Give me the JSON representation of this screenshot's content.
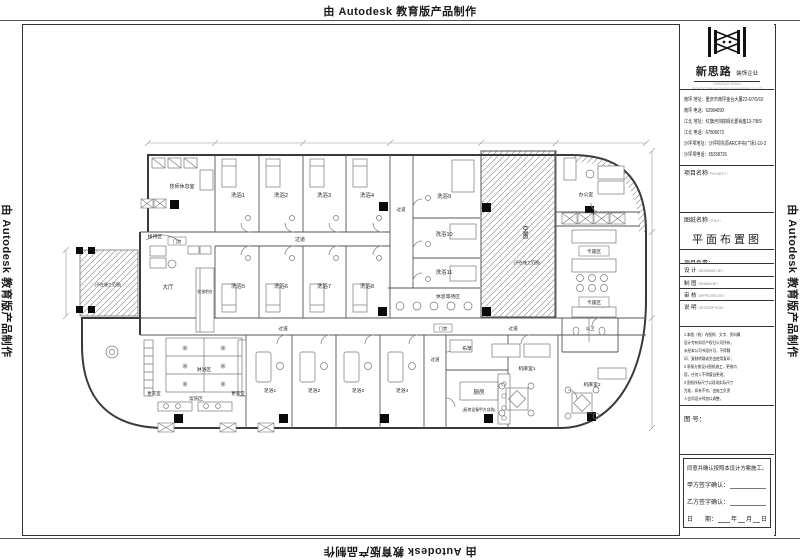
{
  "watermark": {
    "text": "由 Autodesk 教育版产品制作"
  },
  "company": {
    "name": "新思路",
    "type": "装饰企业",
    "en1": "CHONGQING XINSILU",
    "en2": "ARCHITECTURE DECORATION ENGINEERING CO.,LTD",
    "contact1": "南坪 地址：重庆市南坪金台大厦22-6/7/9/10",
    "contact2": "南坪 电话：62984090",
    "contact3": "江北 地址：红旗河沟棕榈北郡尚座13-7/8/9",
    "contact4": "江北 电话：67806073",
    "contact5": "沙坪坝地址：沙坪坝东原ARC中央广场1-10-3",
    "contact6": "沙坪坝电话：65358726"
  },
  "titleblock": {
    "project_cn": "项目名称",
    "project_en": "PROJECT：",
    "drawing_cn": "图纸名称",
    "drawing_en": "TITLE：",
    "drawing_title": "平面布置图",
    "lead": "项目负责：",
    "design_cn": "设 计",
    "design_en": "DESIGNED BY：",
    "draft_cn": "制 图",
    "draft_en": "DRAWN BY：",
    "approve_cn": "审 核",
    "approve_en": "APPROVED BY：",
    "desc_cn": "说 明",
    "desc_en": "DESCRIPTION：",
    "note1": "1 本图（构）内图例、文字、资料属",
    "note2": "   设计专有知识产权归公司所有，",
    "note3": "   未经本公司书面许可，不得翻",
    "note4": "   印、复制转载或交由使用复印；",
    "note5": "2 承接方按设计图纸施工，更改内",
    "note6": "   容，任何人不得擅自更改；",
    "note7": "3 图纸所标尺寸以现场实际尺寸",
    "note8": "   为准，如有不符，由施工负责",
    "note9": "   人会同设计师加以调整。",
    "number": "图 号：",
    "agreement": "同意并确认按照本设计方案施工。",
    "party_a": "甲方签字确认：",
    "party_b": "乙方签字确认：",
    "date_cn": "日　　期：",
    "year": "年",
    "month": "月",
    "day": "日"
  },
  "plan": {
    "tech_rest": "技师休息室",
    "bath1": "洗浴1",
    "bath2": "洗浴2",
    "bath3": "洗浴3",
    "bath4": "洗浴4",
    "bath5": "洗浴5",
    "bath6": "洗浴6",
    "bath7": "洗浴7",
    "bath8": "洗浴8",
    "bath9": "洗浴9",
    "bath10": "洗浴10",
    "bath11": "洗浴11",
    "foot1": "足浴1",
    "foot2": "足浴2",
    "foot3": "足浴3",
    "foot4": "足浴4",
    "reception": "接待区",
    "access": "门禁",
    "lobby": "大厅",
    "cashier": "收银吧台",
    "corridor": "过道",
    "waiting": "休息等待区",
    "vacant": "空置",
    "not_in_scope": "(不在施工范围)",
    "office": "办公室",
    "booth": "卡座区",
    "public_wc": "公卫",
    "locker": "更衣室",
    "shower_area": "淋浴区",
    "wash_area": "盥洗区",
    "linen": "布草",
    "kitchen": "厨房",
    "kitchen_note": "(厨房设备甲方自购)",
    "mahjong1": "机麻室1",
    "mahjong2": "机麻室2"
  }
}
